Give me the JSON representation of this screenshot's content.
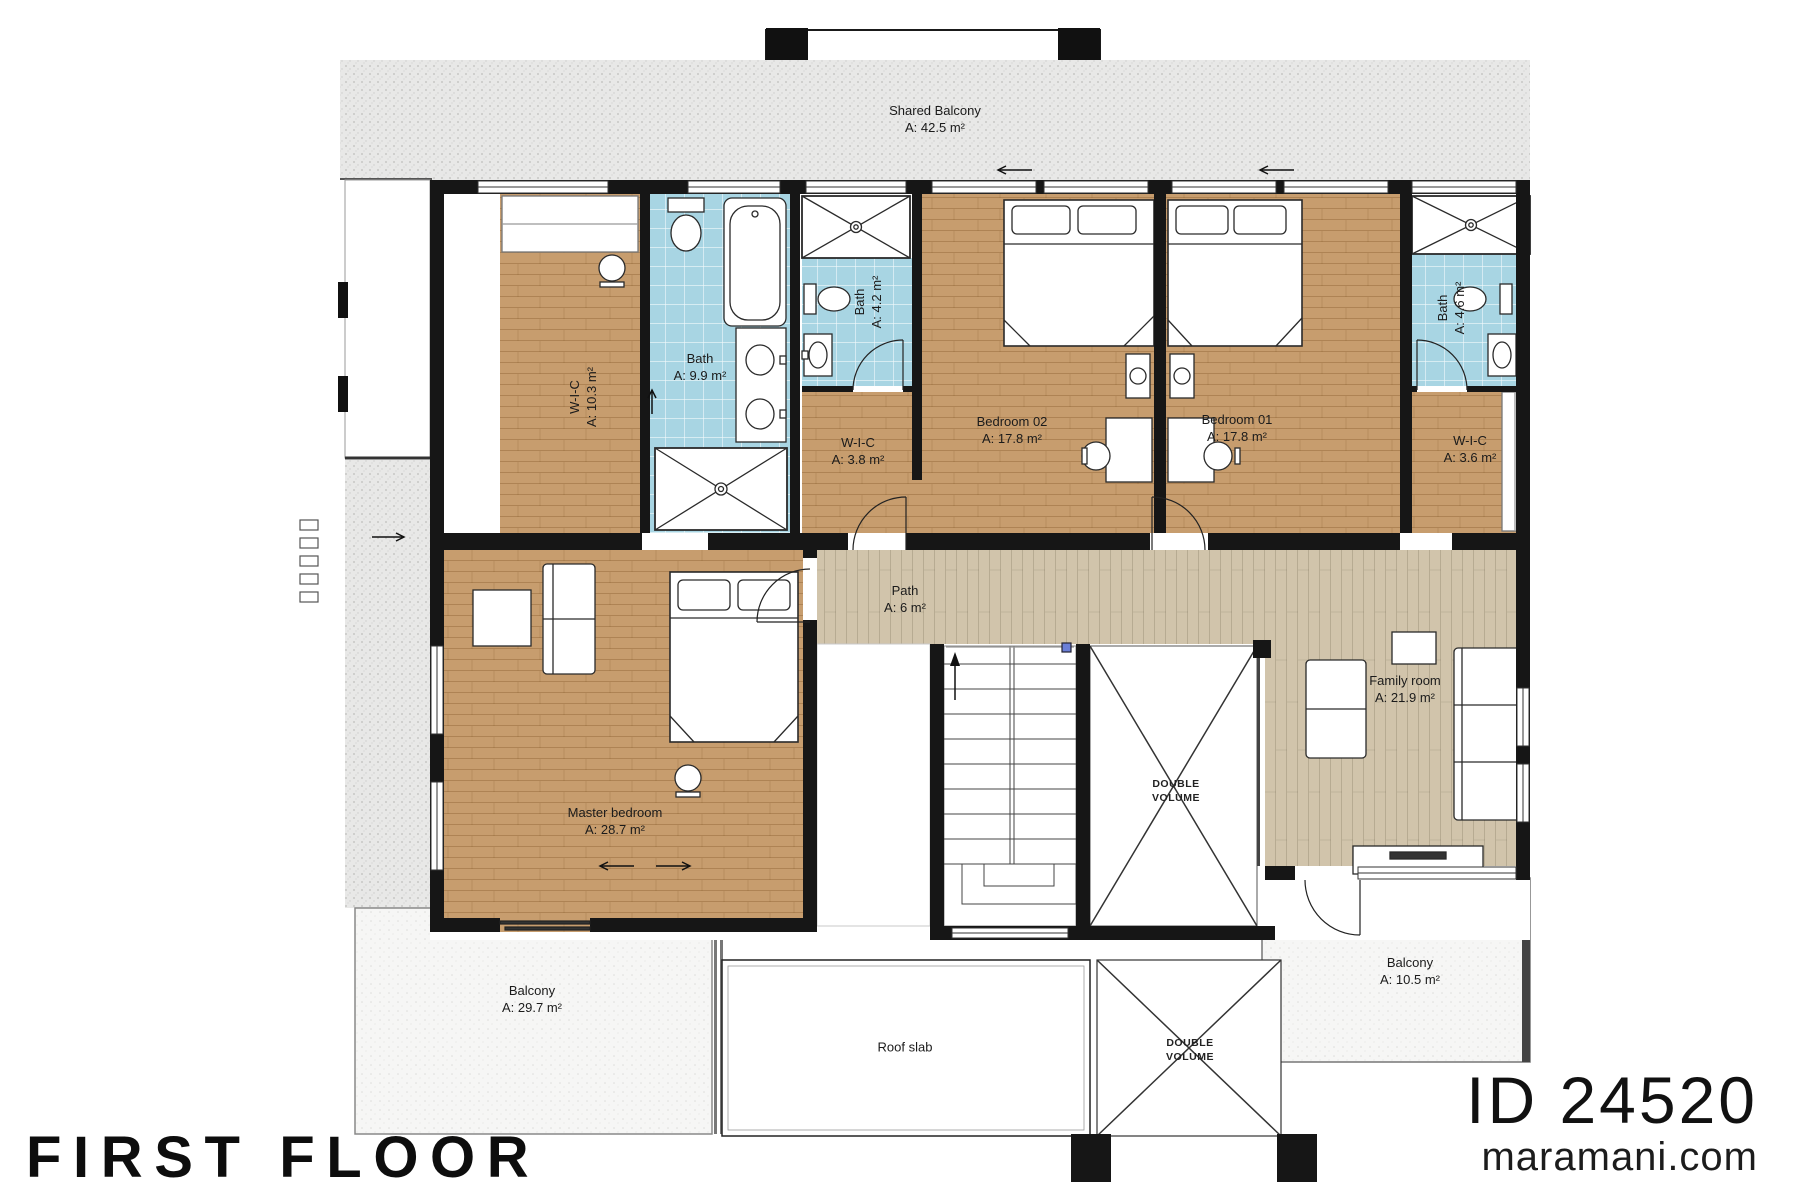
{
  "titles": {
    "floor": "FIRST FLOOR",
    "plan_id": "ID 24520",
    "website": "maramani.com"
  },
  "rooms": {
    "shared_balcony": {
      "name": "Shared Balcony",
      "area": "A: 42.5 m²"
    },
    "wic_master": {
      "name": "W-I-C",
      "area": "A: 10.3 m²"
    },
    "bath_master": {
      "name": "Bath",
      "area": "A: 9.9 m²"
    },
    "bath_shared": {
      "name": "Bath",
      "area": "A: 4.2 m²"
    },
    "wic_bedroom02": {
      "name": "W-I-C",
      "area": "A: 3.8 m²"
    },
    "bedroom02": {
      "name": "Bedroom 02",
      "area": "A: 17.8 m²"
    },
    "bedroom01": {
      "name": "Bedroom 01",
      "area": "A: 17.8 m²"
    },
    "bath_bedroom01": {
      "name": "Bath",
      "area": "A: 4.6 m²"
    },
    "wic_bedroom01": {
      "name": "W-I-C",
      "area": "A: 3.6 m²"
    },
    "path": {
      "name": "Path",
      "area": "A: 6 m²"
    },
    "family_room": {
      "name": "Family room",
      "area": "A: 21.9 m²"
    },
    "master_bedroom": {
      "name": "Master bedroom",
      "area": "A: 28.7 m²"
    },
    "balcony_left": {
      "name": "Balcony",
      "area": "A: 29.7 m²"
    },
    "balcony_right": {
      "name": "Balcony",
      "area": "A: 10.5 m²"
    },
    "roof_slab": {
      "name": "Roof slab"
    },
    "double_volume_upper": {
      "line1": "DOUBLE",
      "line2": "VOLUME"
    },
    "double_volume_lower": {
      "line1": "DOUBLE",
      "line2": "VOLUME"
    }
  },
  "fixtures": [
    "bed-icon",
    "pillow-icon",
    "toilet-icon",
    "bathtub-icon",
    "shower-icon",
    "sink-icon",
    "vanity-icon",
    "sofa-icon",
    "armchair-icon",
    "side-table-icon",
    "tv-cabinet-icon",
    "nightstand-icon",
    "desk-icon",
    "stool-icon",
    "wardrobe-icon",
    "stairs-icon",
    "door-arc",
    "window",
    "double-volume-cross",
    "direction-arrow"
  ],
  "colors": {
    "wall": "#161616",
    "wood_floor": "#c79d6e",
    "light_wood_floor": "#d1c4ab",
    "bathroom_tile": "#a8d5e3",
    "balcony_concrete": "#e8e8e7",
    "balcony_light": "#f6f6f5",
    "fixture_outline": "#2a2a2a"
  }
}
